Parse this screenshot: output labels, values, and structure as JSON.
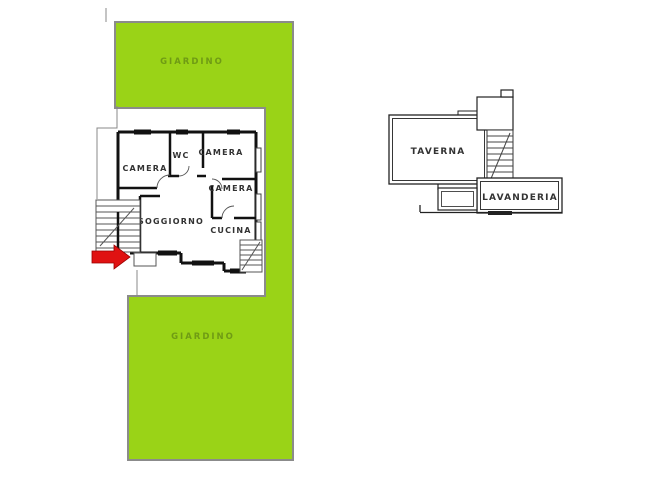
{
  "page": {
    "type": "real-estate floor plan"
  },
  "colors": {
    "garden_fill": "#9AD317",
    "garden_border": "#8B8B8B",
    "garden_label_color": "#6F9B14",
    "wall_color": "#111111",
    "thin_line_color": "#555555",
    "arrow_red": "#E01212",
    "background": "#FFFFFF",
    "room_label_color": "#333333"
  },
  "main_floor": {
    "garden_top_label": "GIARDINO",
    "garden_bottom_label": "GIARDINO",
    "rooms": {
      "camera1": "CAMERA",
      "wc": "WC",
      "camera2": "CAMERA",
      "camera3": "CAMERA",
      "soggiorno": "SOGGIORNO",
      "cucina": "CUCINA"
    }
  },
  "basement": {
    "rooms": {
      "taverna": "TAVERNA",
      "lavanderia": "LAVANDERIA"
    }
  }
}
